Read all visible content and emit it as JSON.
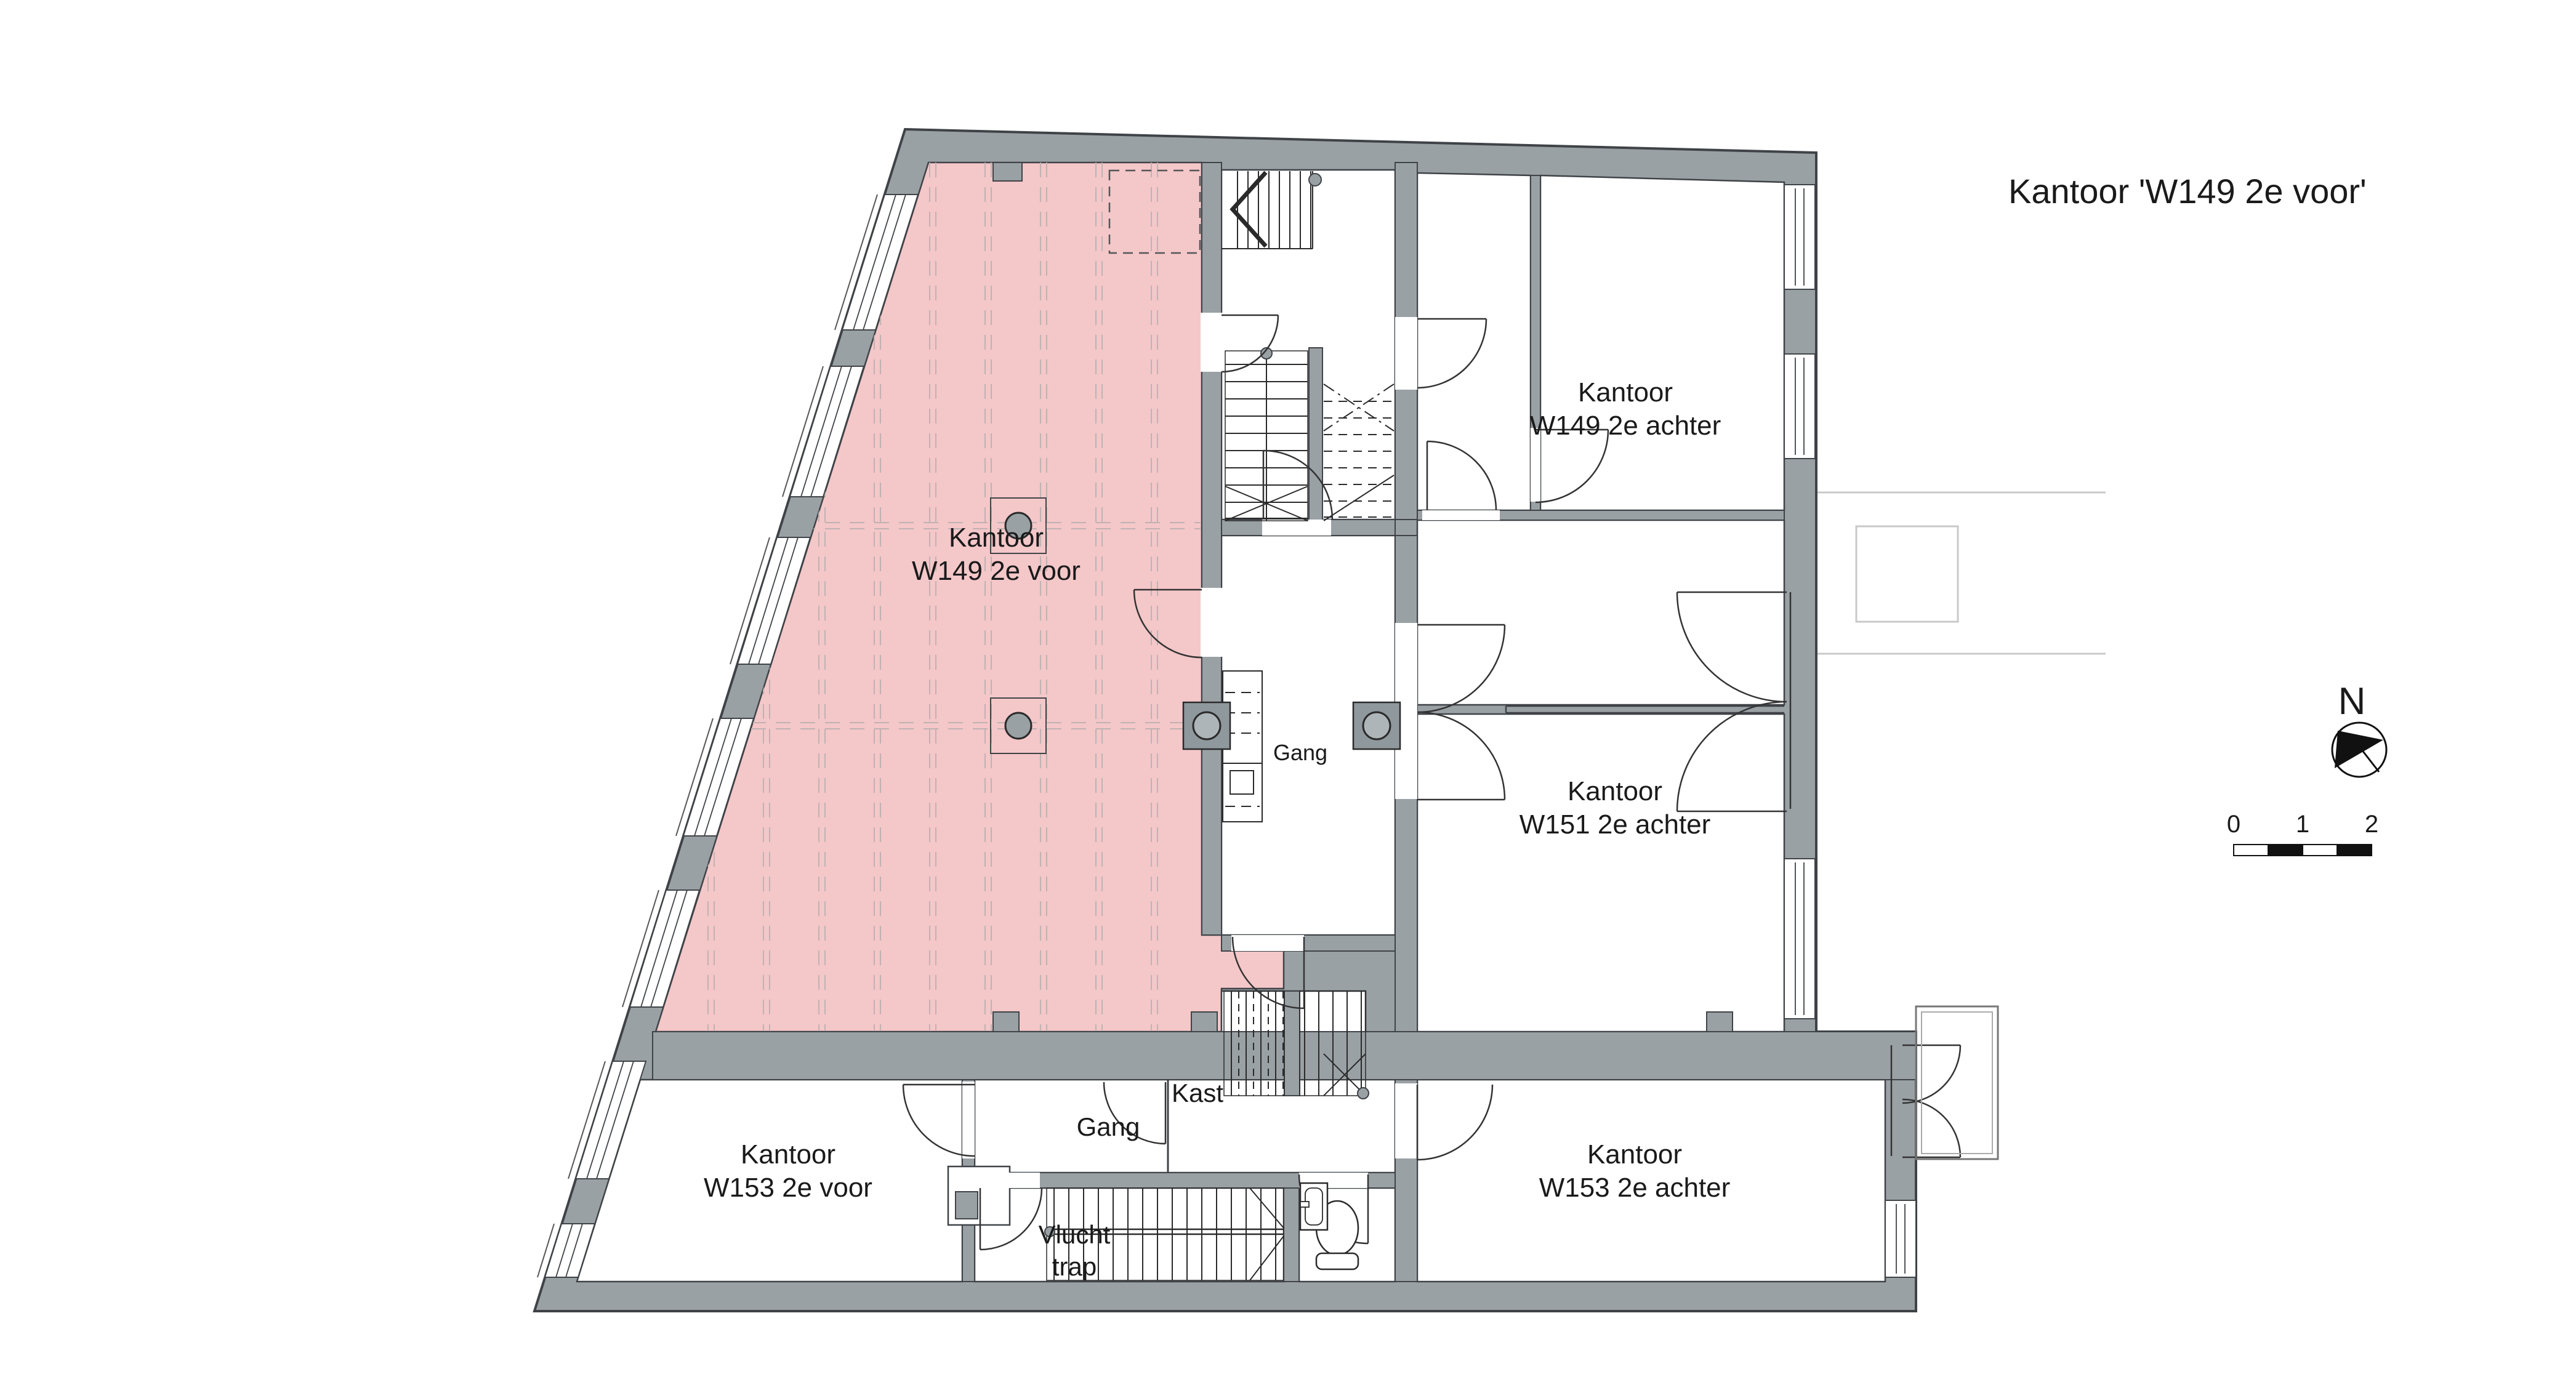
{
  "title": "Kantoor 'W149 2e voor'",
  "rooms": {
    "w149_voor": {
      "line1": "Kantoor",
      "line2": "W149 2e voor"
    },
    "w149_achter": {
      "line1": "Kantoor",
      "line2": "W149 2e achter"
    },
    "w151_achter": {
      "line1": "Kantoor",
      "line2": "W151 2e achter"
    },
    "w153_voor": {
      "line1": "Kantoor",
      "line2": "W153 2e voor"
    },
    "w153_achter": {
      "line1": "Kantoor",
      "line2": "W153 2e achter"
    }
  },
  "spaces": {
    "gang_center": "Gang",
    "gang_south": "Gang",
    "kast": "Kast",
    "vlucht_line1": "Vlucht",
    "vlucht_line2": "trap"
  },
  "compass": {
    "north": "N"
  },
  "scalebar": {
    "t0": "0",
    "t1": "1",
    "t2": "2"
  },
  "colors": {
    "wall": "#9aa1a5",
    "outline": "#3f4347",
    "highlight": "#f4c7c9",
    "grid": "#c0b2b2",
    "faint": "#c9c9c9"
  }
}
